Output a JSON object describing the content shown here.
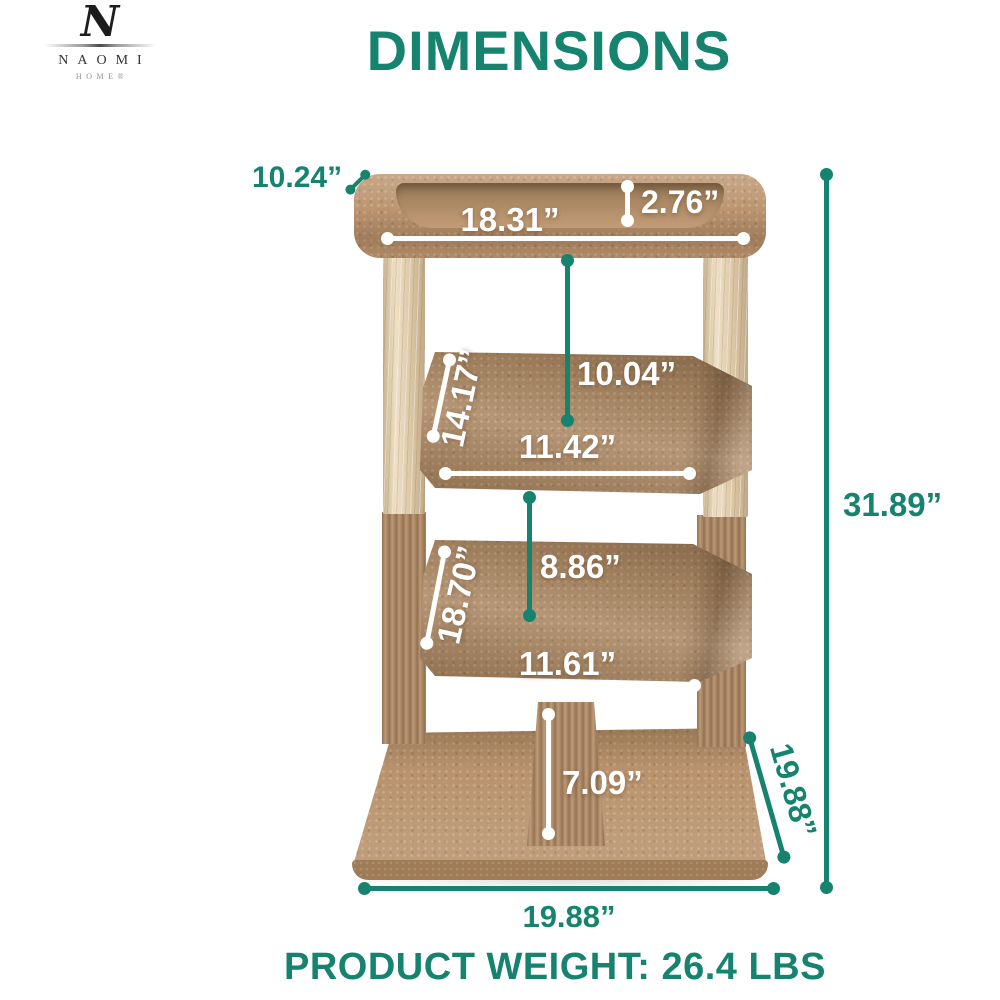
{
  "brand": {
    "monogram": "N",
    "name": "NAOMI",
    "tagline": "HOME®"
  },
  "header": {
    "title": "DIMENSIONS"
  },
  "colors": {
    "accent_teal": "#16836F",
    "annotation_white": "#FFFFFF",
    "carpet_tan": "#B8926C",
    "carpet_dark": "#9F7C57",
    "wood_beige": "#E9D7B6"
  },
  "measurements": {
    "top_platform_depth": "10.24”",
    "top_platform_width": "18.31”",
    "top_platform_lip_height": "2.76”",
    "middle_platform_depth": "14.17”",
    "top_to_middle_spacing": "10.04”",
    "middle_platform_width": "11.42”",
    "lower_platform_depth": "18.70”",
    "middle_to_lower_spacing": "8.86”",
    "lower_platform_width": "11.61”",
    "center_post_height": "7.09”",
    "overall_height": "31.89”",
    "base_depth": "19.88”",
    "base_width": "19.88”"
  },
  "footer": {
    "product_weight": "PRODUCT WEIGHT: 26.4 LBS"
  }
}
